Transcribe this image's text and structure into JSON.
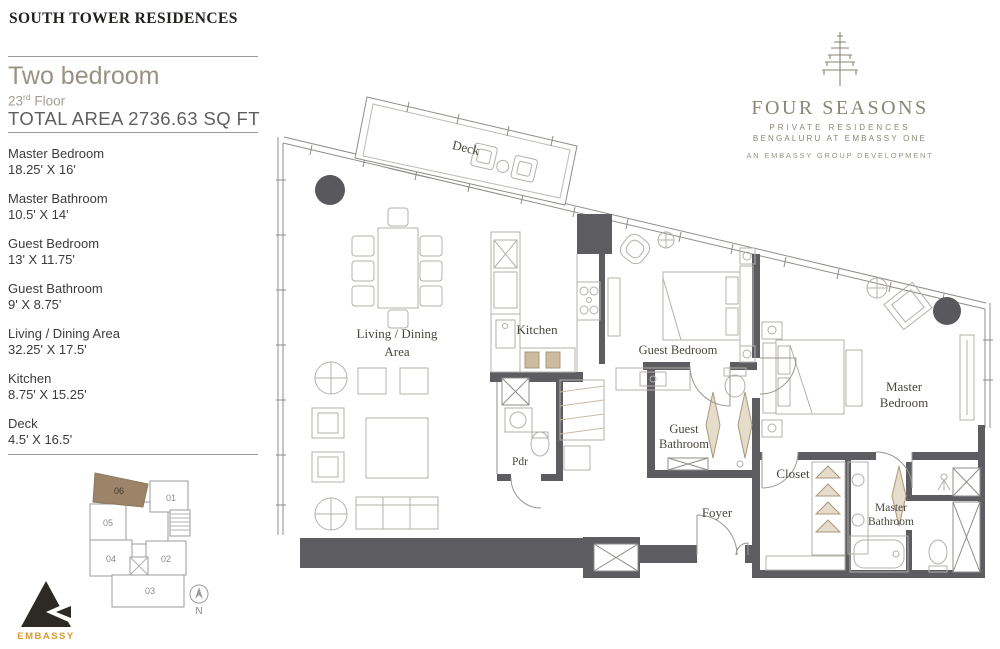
{
  "header": {
    "title": "SOUTH TOWER RESIDENCES"
  },
  "unit_info": {
    "type": "Two bedroom",
    "floor": {
      "number": "23",
      "ordinal": "rd",
      "word": "Floor"
    },
    "total_area": "TOTAL AREA 2736.63 SQ FT"
  },
  "room_list": [
    {
      "name": "Master Bedroom",
      "dims": "18.25' X 16'"
    },
    {
      "name": "Master Bathroom",
      "dims": "10.5' X 14'"
    },
    {
      "name": "Guest Bedroom",
      "dims": "13' X 11.75'"
    },
    {
      "name": "Guest Bathroom",
      "dims": "9' X 8.75'"
    },
    {
      "name": "Living / Dining Area",
      "dims": "32.25' X 17.5'"
    },
    {
      "name": "Kitchen",
      "dims": "8.75' X 15.25'"
    },
    {
      "name": "Deck",
      "dims": "4.5' X 16.5'"
    }
  ],
  "brand": {
    "name": "FOUR SEASONS",
    "line1": "PRIVATE RESIDENCES",
    "line2": "BENGALURU AT EMBASSY ONE",
    "line3": "AN EMBASSY GROUP DEVELOPMENT"
  },
  "developer": {
    "name": "EMBASSY"
  },
  "key_plan": {
    "highlighted_unit": "06",
    "units": {
      "u01": "01",
      "u02": "02",
      "u03": "03",
      "u04": "04",
      "u05": "05",
      "u06": "06"
    },
    "north_label": "N"
  },
  "plan": {
    "labels": {
      "deck": "Deck",
      "living_line1": "Living / Dining",
      "living_line2": "Area",
      "kitchen": "Kitchen",
      "guest_bedroom": "Guest Bedroom",
      "guest_bath_line1": "Guest",
      "guest_bath_line2": "Bathroom",
      "pdr": "Pdr",
      "foyer": "Foyer",
      "master_bed_line1": "Master",
      "master_bed_line2": "Bedroom",
      "closet": "Closet",
      "master_bath_line1": "Master",
      "master_bath_line2": "Bathroom"
    }
  },
  "colors": {
    "wall": "#5d5c61",
    "thin_line": "#8f8d89",
    "furniture_line": "#b3b0ab",
    "accent_tan": "#cdbba0",
    "highlight_unit": "#9c8469",
    "planter": "#59585c",
    "embassy_gold": "#d79b33",
    "brand_gray": "#8b8578"
  }
}
